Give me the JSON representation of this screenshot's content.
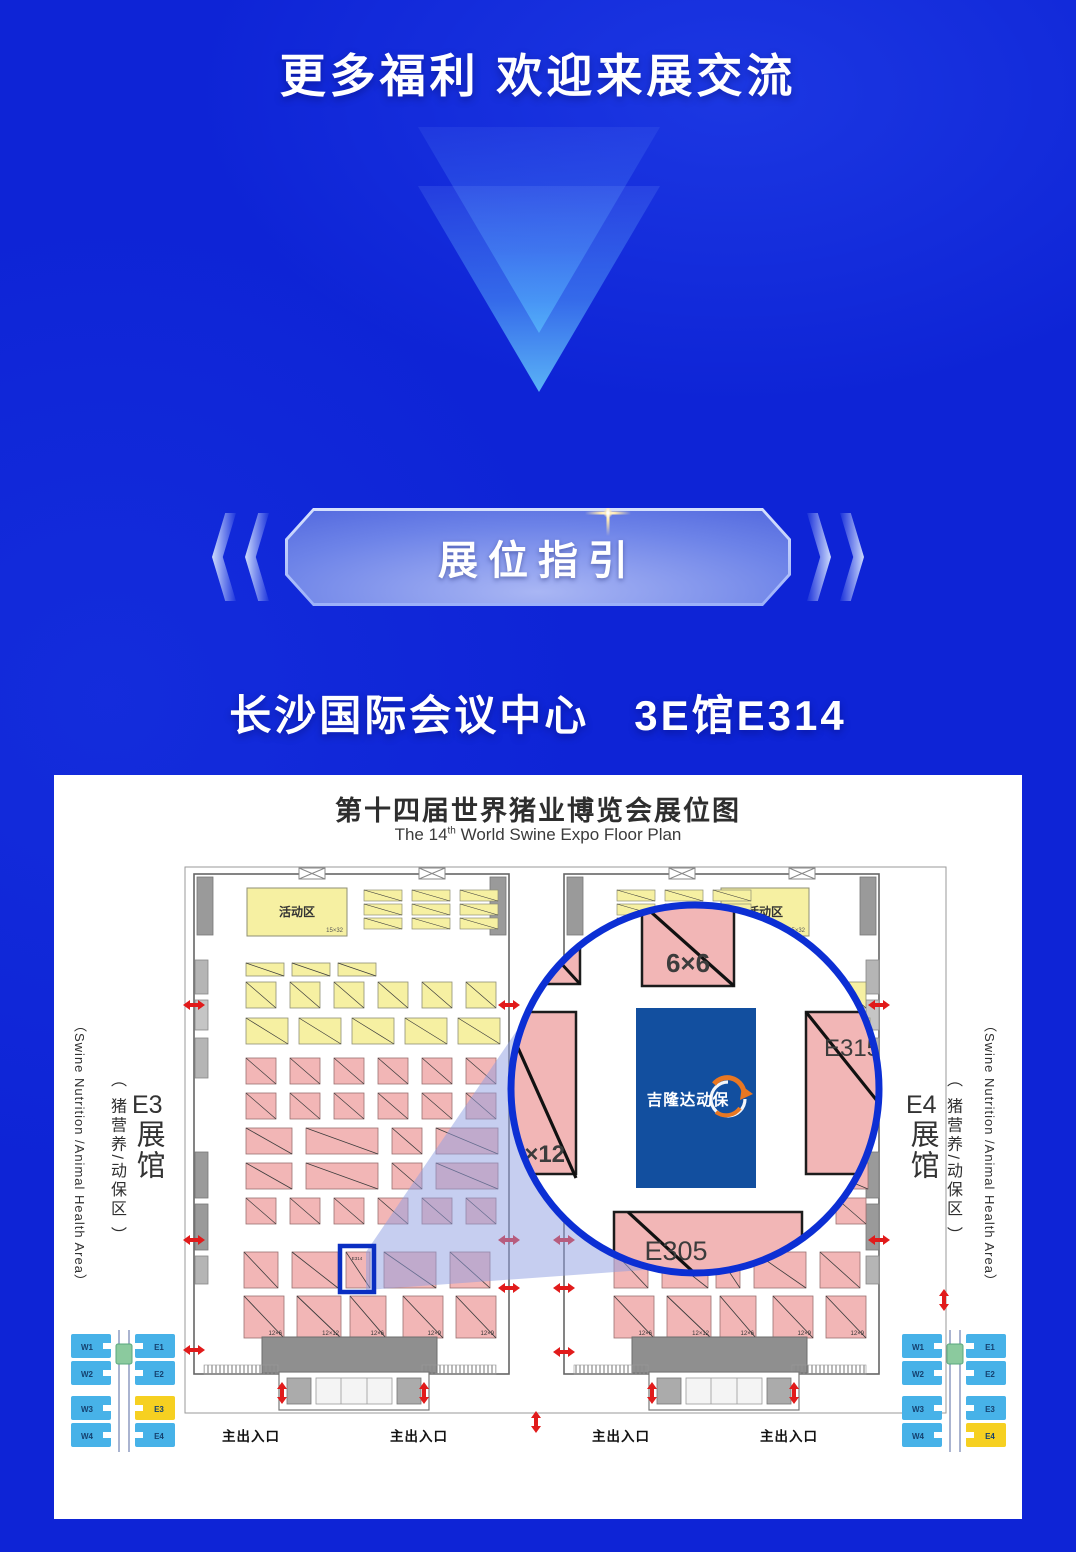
{
  "header": {
    "title": "更多福利 欢迎来展交流"
  },
  "badge": {
    "label": "展位指引"
  },
  "venue": {
    "line": "长沙国际会议中心　3E馆E314"
  },
  "floor_plan": {
    "title": "第十四届世界猪业博览会展位图",
    "subtitle": {
      "pre": "The 14",
      "sup": "th",
      "post": " World Swine Expo Floor Plan"
    },
    "hall_left": {
      "name": "E3",
      "hall_word": "展馆",
      "zone_cn": "（ 猪营养/动保区 ）",
      "zone_en": "（Swine Nutrition /Animal Health Area）"
    },
    "hall_right": {
      "name": "E4",
      "hall_word": "展馆",
      "zone_cn": "（ 猪营养/动保区 ）",
      "zone_en": "（Swine Nutrition /Animal Health Area）"
    },
    "activity": {
      "label": "活动区",
      "size": "15×32"
    },
    "entrance_label": "主出入口",
    "highlight_booth": "E314",
    "booth_dims_left": [
      "12×6",
      "12×12",
      "12×6",
      "12×9",
      "12×9"
    ],
    "booth_dims_right": [
      "12×6",
      "12×12",
      "12×6",
      "12×9",
      "12×9"
    ],
    "magnifier": {
      "booth_top": "6×6",
      "booth_right": "E315",
      "booth_left": "9×12",
      "booth_bottom": "E305",
      "logo_text": "吉隆达动保"
    },
    "minimap": {
      "west": [
        "W1",
        "W2",
        "W3",
        "W4"
      ],
      "east": [
        "E1",
        "E2",
        "E3",
        "E4"
      ],
      "left_highlight": "E3",
      "right_highlight": "E4"
    },
    "colors": {
      "ring": "#0c2fd4",
      "highlight": "#0a2ec2",
      "booth_pink": "#f2b6b6",
      "booth_yellow": "#f6f0a2",
      "logo_blue": "#124f9f",
      "logo_orange": "#e87722",
      "arrow_red": "#e11b1b",
      "minimap_blue": "#47b2e8",
      "minimap_yellow": "#f6d021",
      "minimap_green": "#8bca9e"
    }
  }
}
